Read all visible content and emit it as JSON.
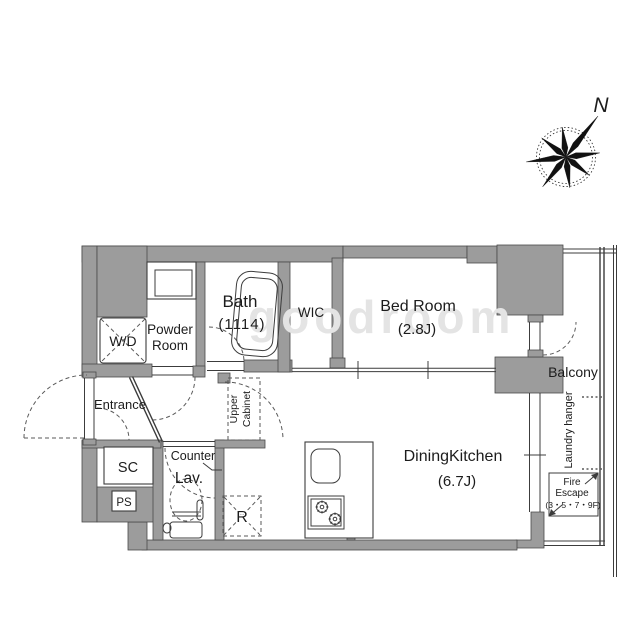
{
  "rooms": {
    "bath": {
      "name": "Bath",
      "size": "(1114)"
    },
    "powder_room": {
      "name_line1": "Powder",
      "name_line2": "Room"
    },
    "washer_dryer": {
      "label": "W/D"
    },
    "wic": {
      "label": "WIC"
    },
    "bed_room": {
      "name": "Bed Room",
      "size": "(2.8J)"
    },
    "entrance": {
      "label": "Entrance"
    },
    "shoe_closet": {
      "label": "SC"
    },
    "pipe_space": {
      "label": "PS"
    },
    "lavatory": {
      "label": "Lav.",
      "counter_label": "Counter"
    },
    "refrigerator_space": {
      "label": "R"
    },
    "upper_cabinet": {
      "line1": "Upper",
      "line2": "Cabinet"
    },
    "dining_kitchen": {
      "name": "DiningKitchen",
      "size": "(6.7J)"
    },
    "balcony": {
      "label": "Balcony",
      "laundry_hanger": "Laundry hanger"
    },
    "fire_escape": {
      "line1": "Fire",
      "line2": "Escape",
      "line3": "(3・5・7・9F)"
    }
  },
  "compass": {
    "north_label": "N"
  },
  "watermark": {
    "text": "goodroom"
  },
  "colors": {
    "wall": "#9c9c9c",
    "line": "#3c3c3c",
    "dash": "#5a5a5a",
    "text": "#1c1c1c",
    "watermark": "#e4e4e4"
  }
}
